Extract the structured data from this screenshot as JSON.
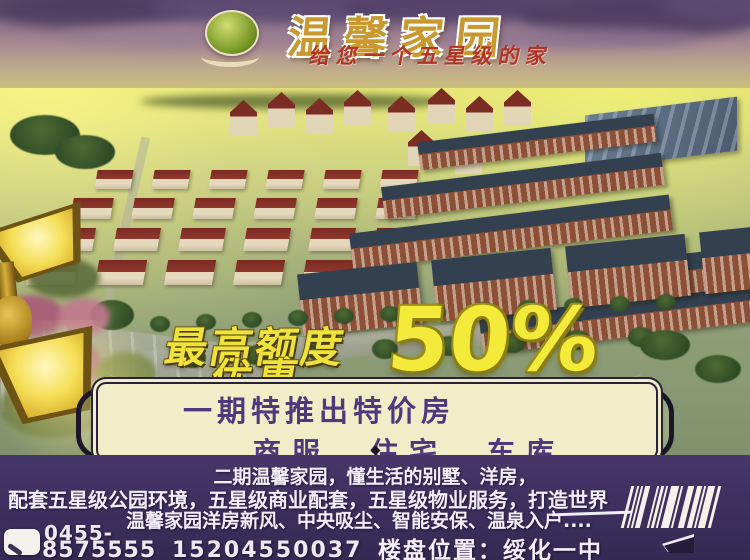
{
  "poster": {
    "header": {
      "logo": "green-orb-logo",
      "title": "温馨家园",
      "subtitle": "给您一个五星级的家"
    },
    "promo": {
      "limit_line1": "最高额度",
      "limit_line2": "优惠",
      "discount": "50%"
    },
    "banner": {
      "line1": "一期特推出特价房",
      "line2": "商服、住宅、车库"
    },
    "description": {
      "line1": "二期温馨家园，懂生活的别墅、洋房，",
      "line2": "配套五星级公园环境，五星级商业配套，五星级物业服务，打造世界",
      "line3": "温馨家园洋房新风、中央吸尘、智能安保、温泉入户...."
    },
    "contact": {
      "area_code": "0455-",
      "phone": "8575555",
      "mobile": "15204550037",
      "location_label": "楼盘位置：",
      "location_value": "绥化一中"
    },
    "colors": {
      "accent_yellow": "#f2e63a",
      "title_gold": "#c9992f",
      "subtitle_red": "#b23429",
      "banner_bg": "#f0eec9",
      "banner_text": "#4c3a7c",
      "panel_purple": "#3e3163",
      "body_text": "#f2eef8"
    }
  }
}
